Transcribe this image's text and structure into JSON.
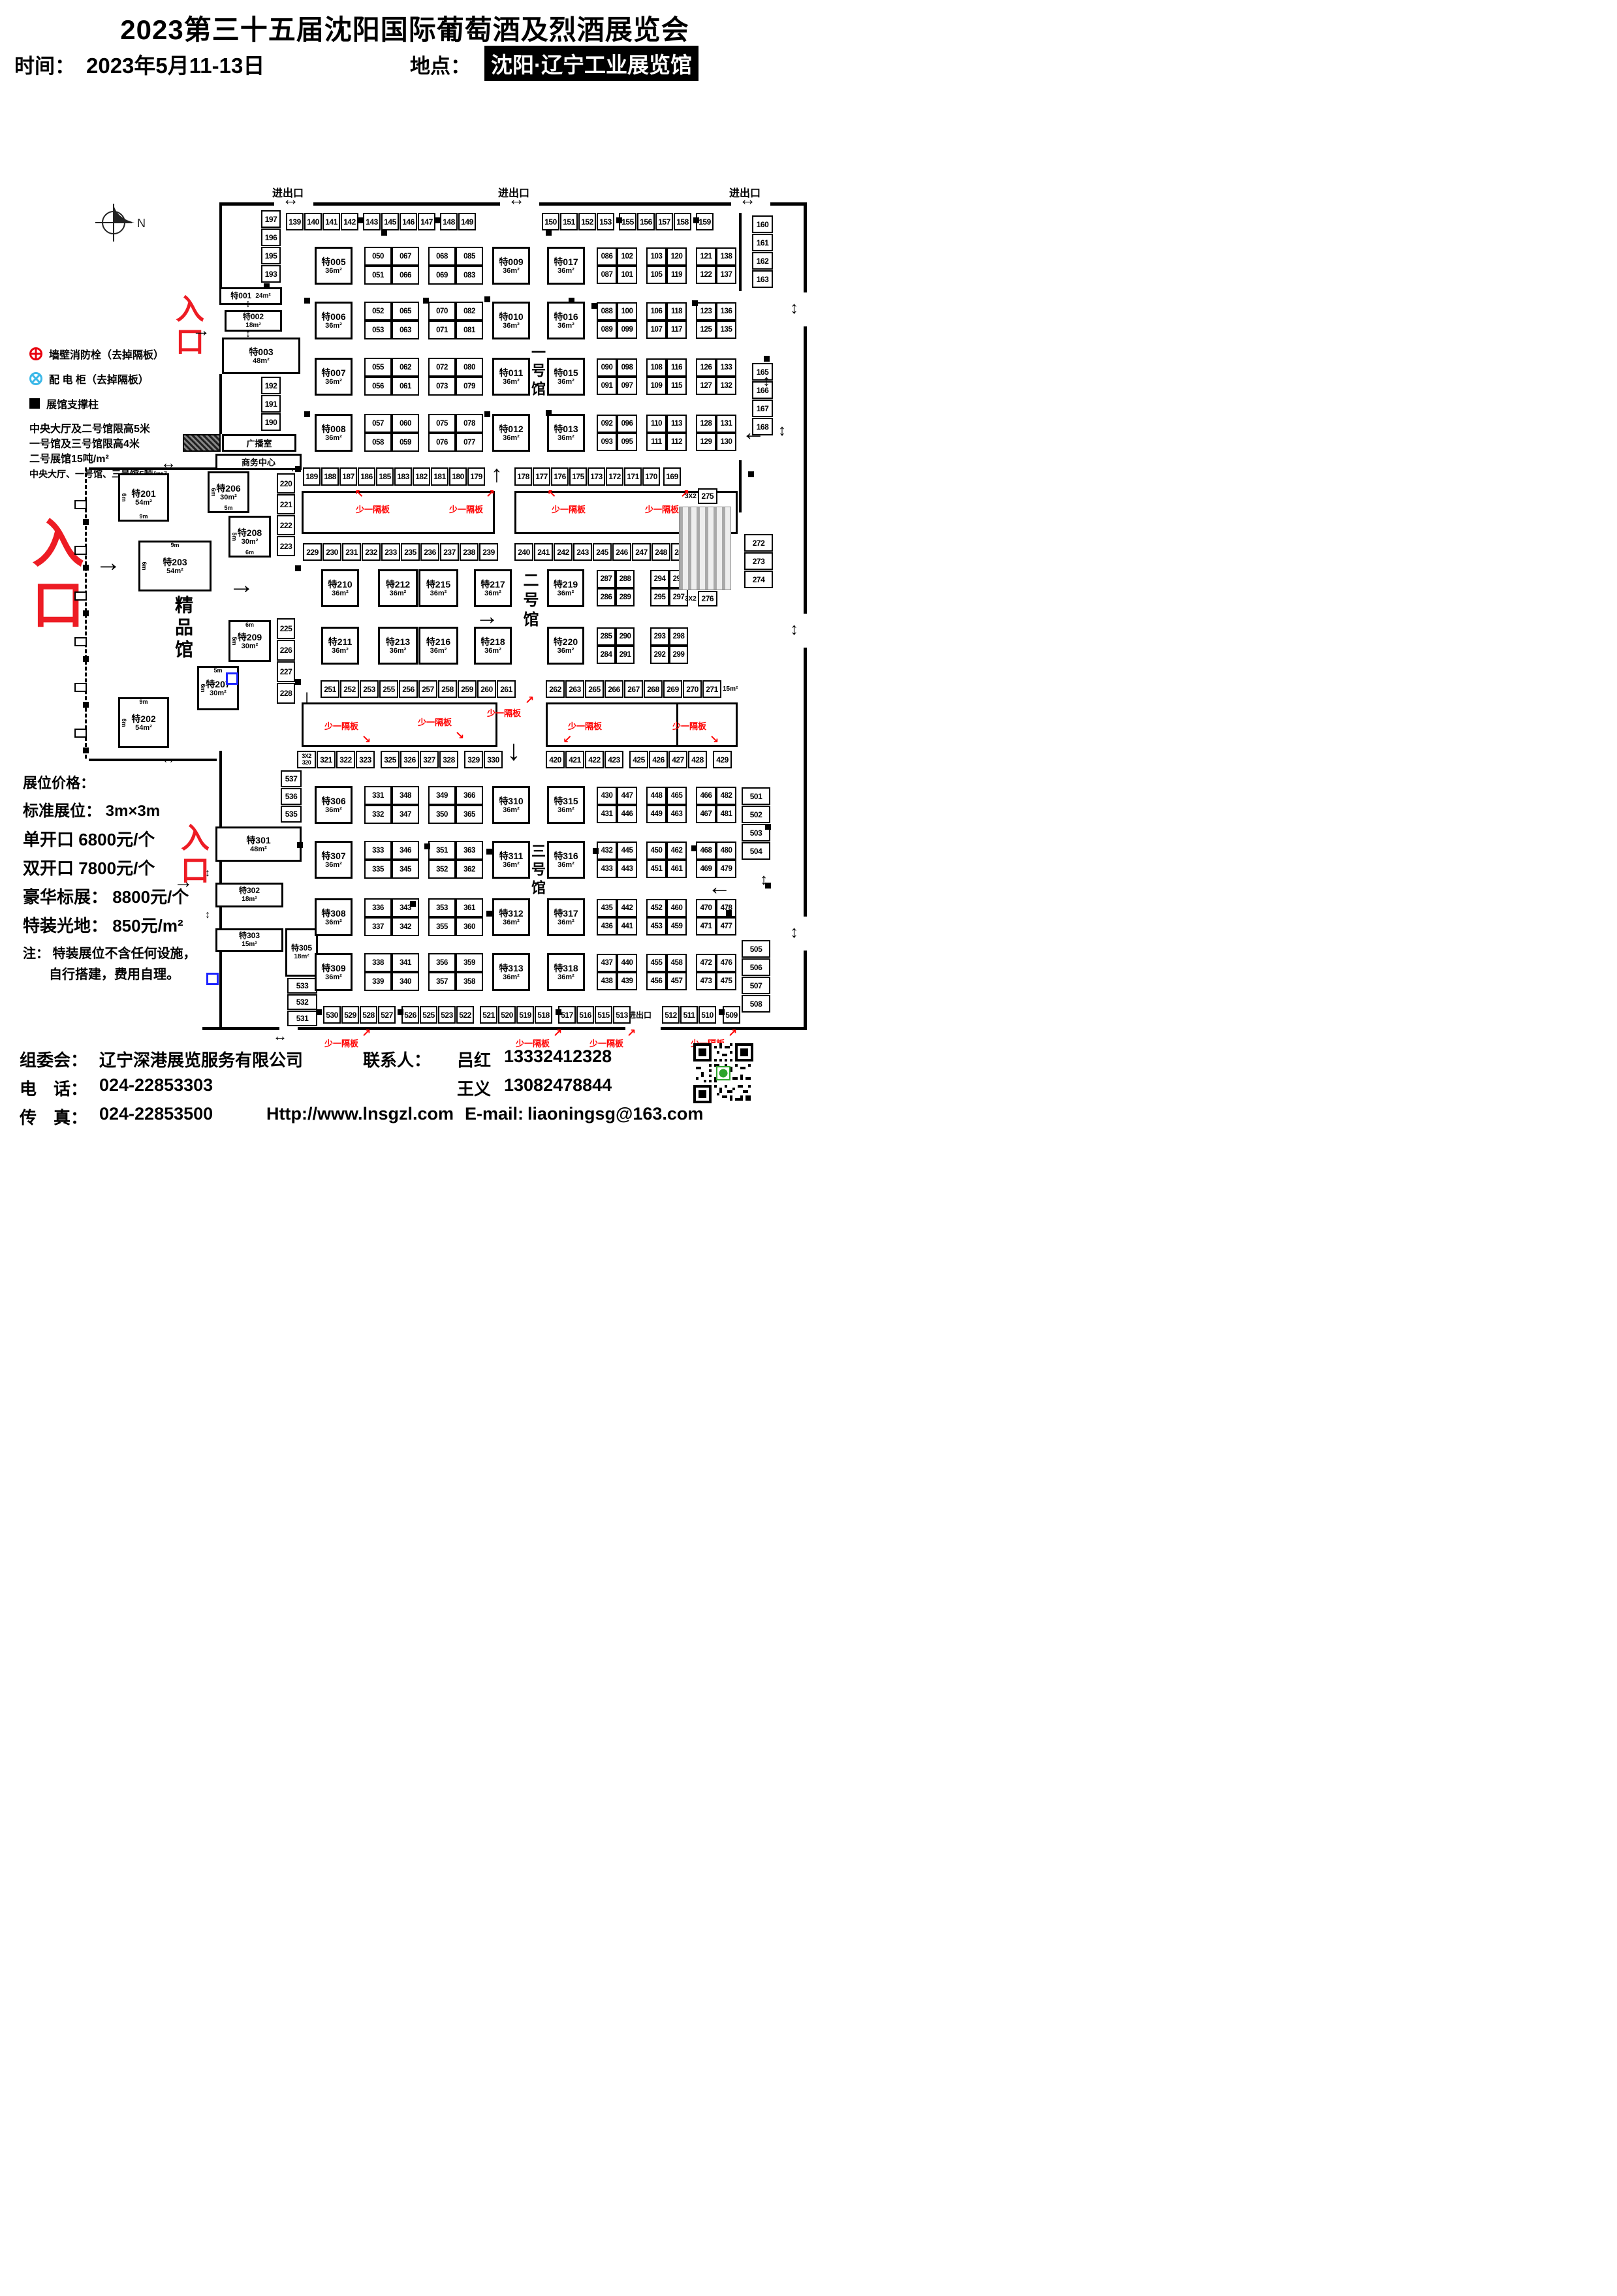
{
  "header": {
    "title": "2023第三十五届沈阳国际葡萄酒及烈酒展览会",
    "time_label": "时间：",
    "time_value": "2023年5月11-13日",
    "place_label": "地点：",
    "place_value": "沈阳·辽宁工业展览馆"
  },
  "labels": {
    "entrance": "入口",
    "gate": "进出口",
    "partition": "少一隔板",
    "hall1": "一号馆",
    "hall2": "二号馆",
    "hall3": "三号馆",
    "boutique": "精品馆",
    "broadcast": "广播室",
    "business_center": "商务中心",
    "north": "N"
  },
  "legend": {
    "fire": "墙壁消防栓（去掉隔板）",
    "power": "配 电 柜（去掉隔板）",
    "pillar": "展馆支撑柱",
    "notes": [
      "中央大厅及二号馆限高5米",
      "一号馆及三号馆限高4米",
      "二号展馆15吨/m²",
      "中央大厅、一号馆、三号馆5吨/m²"
    ]
  },
  "pricing": {
    "title": "展位价格：",
    "lines": [
      "标准展位： 3m×3m",
      "单开口 6800元/个",
      "双开口 7800元/个",
      "豪华标展： 8800元/个",
      "特装光地： 850元/m²"
    ],
    "note1": "注： 特装展位不含任何设施，",
    "note2": "自行搭建，费用自理。"
  },
  "contact": {
    "committee_label": "组委会：",
    "committee": "辽宁深港展览服务有限公司",
    "contact_label": "联系人：",
    "contact1_name": "吕红",
    "contact1_phone": "13332412328",
    "contact2_name": "王义",
    "contact2_phone": "13082478844",
    "phone_label": "电　话：",
    "phone": "024-22853303",
    "fax_label": "传　真：",
    "fax": "024-22853500",
    "website": "Http://www.lnsgzl.com",
    "email_label": "E-mail:",
    "email": "liaoningsg@163.com"
  },
  "strips": {
    "t1": [
      "139",
      "140",
      "141",
      "142"
    ],
    "t2": [
      "143",
      "145",
      "146",
      "147"
    ],
    "t3": [
      "148",
      "149"
    ],
    "t4": [
      "150",
      "151",
      "152",
      "153"
    ],
    "t5": [
      "155",
      "156",
      "157",
      "158"
    ],
    "t6": [
      "159"
    ],
    "r160": [
      "160",
      "161",
      "162",
      "163"
    ],
    "r165": [
      "165",
      "166",
      "167",
      "168"
    ],
    "l197": [
      "197",
      "196",
      "195",
      "193"
    ],
    "l192": [
      "192",
      "191",
      "190"
    ],
    "m1": [
      "189",
      "188",
      "187",
      "186"
    ],
    "m2": [
      "185",
      "183",
      "182",
      "181"
    ],
    "m3": [
      "180",
      "179"
    ],
    "m4": [
      "178",
      "177",
      "176",
      "175"
    ],
    "m5": [
      "173",
      "172",
      "171",
      "170"
    ],
    "m6": [
      "169"
    ],
    "a229": [
      "229",
      "230",
      "231",
      "232",
      "233",
      "235",
      "236",
      "237",
      "238",
      "239"
    ],
    "a240": [
      "240",
      "241",
      "242",
      "243",
      "245",
      "246",
      "247",
      "248",
      "249",
      {
        "t": "250",
        "sub": "2X3"
      }
    ],
    "b220": [
      "220",
      "221",
      "222",
      "223"
    ],
    "b225": [
      "225",
      "226",
      "227",
      "228"
    ],
    "a251": [
      "251",
      "252",
      "253",
      "255",
      "256",
      "257",
      "258",
      "259",
      "260",
      "261"
    ],
    "a262": [
      "262",
      "263",
      "265",
      "266",
      "267",
      "268",
      "269",
      "270",
      "271",
      {
        "label": "15m²"
      }
    ],
    "a320": [
      {
        "two": [
          "3X2",
          "320"
        ]
      },
      "321",
      "322",
      "323"
    ],
    "a325": [
      "325",
      "326",
      "327",
      "328"
    ],
    "a329": [
      "329",
      "330"
    ],
    "a420": [
      "420",
      "421",
      "422",
      "423"
    ],
    "a425": [
      "425",
      "426",
      "427",
      "428"
    ],
    "a429": [
      "429"
    ],
    "c275": [
      {
        "pre": "3X2",
        "t": "275"
      }
    ],
    "c276": [
      {
        "pre": "3X2",
        "t": "276"
      }
    ],
    "r272": [
      "272",
      "273",
      "274"
    ],
    "r501": [
      "501",
      "502",
      "503",
      "504"
    ],
    "r505": [
      "505",
      "506",
      "507",
      "508"
    ],
    "l537": [
      "537",
      "536",
      "535"
    ],
    "l533": [
      "533",
      "532",
      "531"
    ],
    "bot1": [
      "530",
      "529",
      "528",
      "527"
    ],
    "bot2": [
      "526",
      "525",
      "523",
      "522"
    ],
    "bot3": [
      "521",
      "520",
      "519",
      "518"
    ],
    "bot4": [
      "517",
      "516",
      "515",
      "513"
    ],
    "bot5": [
      "512",
      "511",
      "510"
    ],
    "bot6": [
      "509"
    ]
  },
  "quads": {
    "q1": [
      "050",
      "067",
      "051",
      "066"
    ],
    "q2": [
      "068",
      "085",
      "069",
      "083"
    ],
    "q3": [
      "086",
      "102",
      "087",
      "101"
    ],
    "q4": [
      "103",
      "120",
      "105",
      "119"
    ],
    "q5": [
      "121",
      "138",
      "122",
      "137"
    ],
    "q6": [
      "052",
      "065",
      "053",
      "063"
    ],
    "q7": [
      "070",
      "082",
      "071",
      "081"
    ],
    "q8": [
      "088",
      "100",
      "089",
      "099"
    ],
    "q9": [
      "106",
      "118",
      "107",
      "117"
    ],
    "q10": [
      "123",
      "136",
      "125",
      "135"
    ],
    "q11": [
      "055",
      "062",
      "056",
      "061"
    ],
    "q12": [
      "072",
      "080",
      "073",
      "079"
    ],
    "q13": [
      "090",
      "098",
      "091",
      "097"
    ],
    "q14": [
      "108",
      "116",
      "109",
      "115"
    ],
    "q15": [
      "126",
      "133",
      "127",
      "132"
    ],
    "q16": [
      "057",
      "060",
      "058",
      "059"
    ],
    "q17": [
      "075",
      "078",
      "076",
      "077"
    ],
    "q18": [
      "092",
      "096",
      "093",
      "095"
    ],
    "q19": [
      "110",
      "113",
      "111",
      "112"
    ],
    "q20": [
      "128",
      "131",
      "129",
      "130"
    ],
    "q21": [
      "287",
      "288",
      "286",
      "289"
    ],
    "q22": [
      "294",
      "296",
      "295",
      "297"
    ],
    "q23": [
      "285",
      "290",
      "284",
      "291"
    ],
    "q24": [
      "293",
      "298",
      "292",
      "299"
    ],
    "q25": [
      "331",
      "348",
      "332",
      "347"
    ],
    "q26": [
      "349",
      "366",
      "350",
      "365"
    ],
    "q27": [
      "430",
      "447",
      "431",
      "446"
    ],
    "q28": [
      "448",
      "465",
      "449",
      "463"
    ],
    "q29": [
      "466",
      "482",
      "467",
      "481"
    ],
    "q30": [
      "333",
      "346",
      "335",
      "345"
    ],
    "q31": [
      "351",
      "363",
      "352",
      "362"
    ],
    "q32": [
      "432",
      "445",
      "433",
      "443"
    ],
    "q33": [
      "450",
      "462",
      "451",
      "461"
    ],
    "q34": [
      "468",
      "480",
      "469",
      "479"
    ],
    "q35": [
      "336",
      "343",
      "337",
      "342"
    ],
    "q36": [
      "353",
      "361",
      "355",
      "360"
    ],
    "q37": [
      "435",
      "442",
      "436",
      "441"
    ],
    "q38": [
      "452",
      "460",
      "453",
      "459"
    ],
    "q39": [
      "470",
      "478",
      "471",
      "477"
    ],
    "q40": [
      "338",
      "341",
      "339",
      "340"
    ],
    "q41": [
      "356",
      "359",
      "357",
      "358"
    ],
    "q42": [
      "437",
      "440",
      "438",
      "439"
    ],
    "q43": [
      "455",
      "458",
      "456",
      "457"
    ],
    "q44": [
      "472",
      "476",
      "473",
      "475"
    ]
  },
  "specials": {
    "s001": {
      "name": "特001",
      "area": "24m²"
    },
    "s002": {
      "name": "特002",
      "area": "18m²"
    },
    "s003": {
      "name": "特003",
      "area": "48m²"
    },
    "s005": {
      "name": "特005",
      "area": "36m²"
    },
    "s006": {
      "name": "特006",
      "area": "36m²"
    },
    "s007": {
      "name": "特007",
      "area": "36m²"
    },
    "s008": {
      "name": "特008",
      "area": "36m²"
    },
    "s009": {
      "name": "特009",
      "area": "36m²"
    },
    "s010": {
      "name": "特010",
      "area": "36m²"
    },
    "s011": {
      "name": "特011",
      "area": "36m²"
    },
    "s012": {
      "name": "特012",
      "area": "36m²"
    },
    "s013": {
      "name": "特013",
      "area": "36m²"
    },
    "s015": {
      "name": "特015",
      "area": "36m²"
    },
    "s016": {
      "name": "特016",
      "area": "36m²"
    },
    "s017": {
      "name": "特017",
      "area": "36m²"
    },
    "s201": {
      "name": "特201",
      "area": "54m²",
      "left": "6m",
      "bottom": "9m"
    },
    "s202": {
      "name": "特202",
      "area": "54m²",
      "top": "9m",
      "left": "6m"
    },
    "s203": {
      "name": "特203",
      "area": "54m²",
      "top": "9m",
      "left": "6m"
    },
    "s206": {
      "name": "特206",
      "area": "30m²",
      "left": "6m",
      "bottom": "5m"
    },
    "s207": {
      "name": "特207",
      "area": "30m²",
      "top": "5m",
      "left": "6m"
    },
    "s208": {
      "name": "特208",
      "area": "30m²",
      "left": "5m",
      "bottom": "6m"
    },
    "s209": {
      "name": "特209",
      "area": "30m²",
      "top": "6m",
      "left": "5m"
    },
    "s210": {
      "name": "特210",
      "area": "36m²"
    },
    "s211": {
      "name": "特211",
      "area": "36m²"
    },
    "s212": {
      "name": "特212",
      "area": "36m²"
    },
    "s213": {
      "name": "特213",
      "area": "36m²"
    },
    "s215": {
      "name": "特215",
      "area": "36m²"
    },
    "s216": {
      "name": "特216",
      "area": "36m²"
    },
    "s217": {
      "name": "特217",
      "area": "36m²"
    },
    "s218": {
      "name": "特218",
      "area": "36m²"
    },
    "s219": {
      "name": "特219",
      "area": "36m²"
    },
    "s220": {
      "name": "特220",
      "area": "36m²"
    },
    "s301": {
      "name": "特301",
      "area": "48m²"
    },
    "s302": {
      "name": "特302",
      "area": "18m²"
    },
    "s303": {
      "name": "特303",
      "area": "15m²"
    },
    "s305": {
      "name": "特305",
      "area": "18m²"
    },
    "s306": {
      "name": "特306",
      "area": "36m²"
    },
    "s307": {
      "name": "特307",
      "area": "36m²"
    },
    "s308": {
      "name": "特308",
      "area": "36m²"
    },
    "s309": {
      "name": "特309",
      "area": "36m²"
    },
    "s310": {
      "name": "特310",
      "area": "36m²"
    },
    "s311": {
      "name": "特311",
      "area": "36m²"
    },
    "s312": {
      "name": "特312",
      "area": "36m²"
    },
    "s313": {
      "name": "特313",
      "area": "36m²"
    },
    "s315": {
      "name": "特315",
      "area": "36m²"
    },
    "s316": {
      "name": "特316",
      "area": "36m²"
    },
    "s317": {
      "name": "特317",
      "area": "36m²"
    },
    "s318": {
      "name": "特318",
      "area": "36m²"
    }
  }
}
